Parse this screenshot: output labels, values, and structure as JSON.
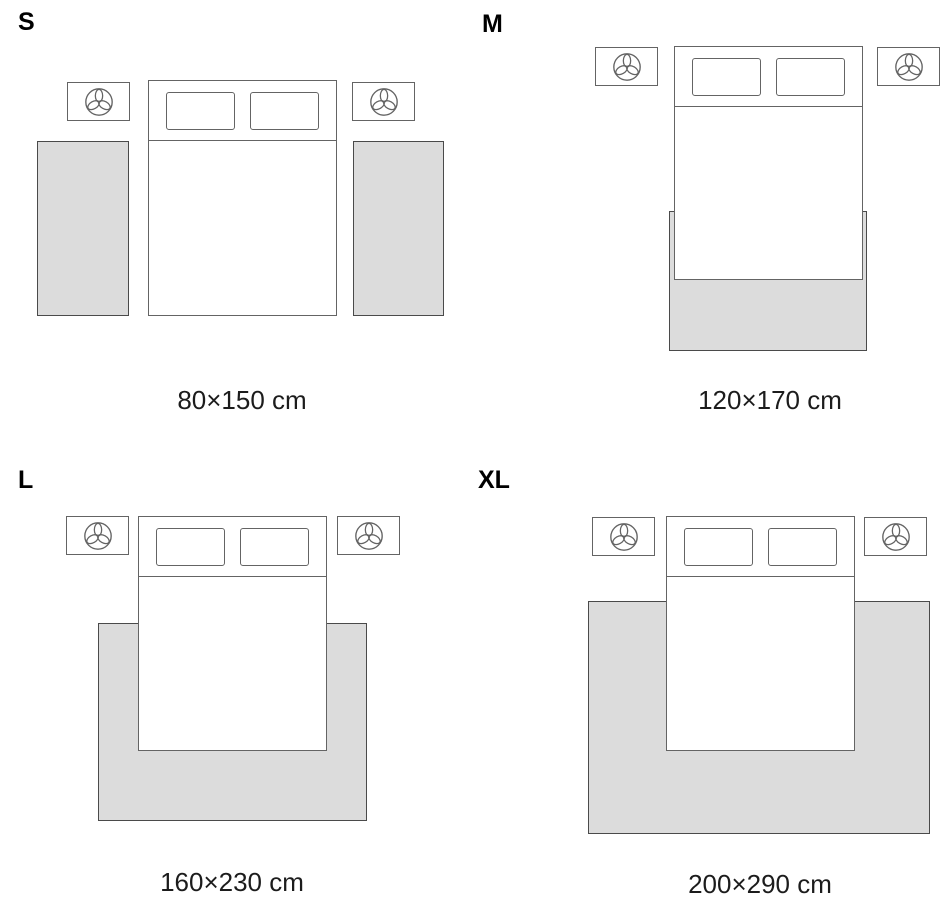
{
  "title": "Rug size guide — bedroom layouts",
  "colors": {
    "background": "#ffffff",
    "rug_fill": "#dcdcdc",
    "rug_border": "#4a4a4a",
    "furniture_border": "#646464",
    "letter_color": "#000000",
    "caption_color": "#1c1c1c"
  },
  "bed_parts": {
    "headboard_height": 59,
    "pillows": [
      {
        "x": 17,
        "y": 11,
        "w": 69,
        "h": 38
      },
      {
        "x": 101,
        "y": 11,
        "w": 69,
        "h": 38
      }
    ]
  },
  "nightstand": {
    "w": 63,
    "h": 39,
    "icon": "plant-top-view-icon"
  },
  "panels": [
    {
      "label": "S",
      "size_label": "80×150 cm",
      "diagram": {
        "letter": {
          "x": 18,
          "y": 10
        },
        "bed": {
          "x": 148,
          "y": 80,
          "w": 189,
          "h": 236
        },
        "nightstands": [
          {
            "x": 67,
            "y": 82
          },
          {
            "x": 352,
            "y": 82
          }
        ],
        "rugs": [
          {
            "x": 37,
            "y": 141,
            "w": 92,
            "h": 175
          },
          {
            "x": 353,
            "y": 141,
            "w": 91,
            "h": 175
          }
        ],
        "caption": {
          "cx": 242,
          "y": 387
        }
      }
    },
    {
      "label": "M",
      "size_label": "120×170 cm",
      "diagram": {
        "letter": {
          "x": 482,
          "y": 12
        },
        "bed": {
          "x": 674,
          "y": 46,
          "w": 189,
          "h": 234
        },
        "nightstands": [
          {
            "x": 595,
            "y": 47
          },
          {
            "x": 877,
            "y": 47
          }
        ],
        "rugs": [
          {
            "x": 669,
            "y": 211,
            "w": 198,
            "h": 140
          }
        ],
        "caption": {
          "cx": 770,
          "y": 387
        }
      }
    },
    {
      "label": "L",
      "size_label": "160×230 cm",
      "diagram": {
        "letter": {
          "x": 18,
          "y": 468
        },
        "bed": {
          "x": 138,
          "y": 516,
          "w": 189,
          "h": 235
        },
        "nightstands": [
          {
            "x": 66,
            "y": 516
          },
          {
            "x": 337,
            "y": 516
          }
        ],
        "rugs": [
          {
            "x": 98,
            "y": 623,
            "w": 269,
            "h": 198
          }
        ],
        "caption": {
          "cx": 232,
          "y": 869
        }
      }
    },
    {
      "label": "XL",
      "size_label": "200×290 cm",
      "diagram": {
        "letter": {
          "x": 478,
          "y": 468
        },
        "bed": {
          "x": 666,
          "y": 516,
          "w": 189,
          "h": 235
        },
        "nightstands": [
          {
            "x": 592,
            "y": 517
          },
          {
            "x": 864,
            "y": 517
          }
        ],
        "rugs": [
          {
            "x": 588,
            "y": 601,
            "w": 342,
            "h": 233
          }
        ],
        "caption": {
          "cx": 760,
          "y": 871
        }
      }
    }
  ]
}
